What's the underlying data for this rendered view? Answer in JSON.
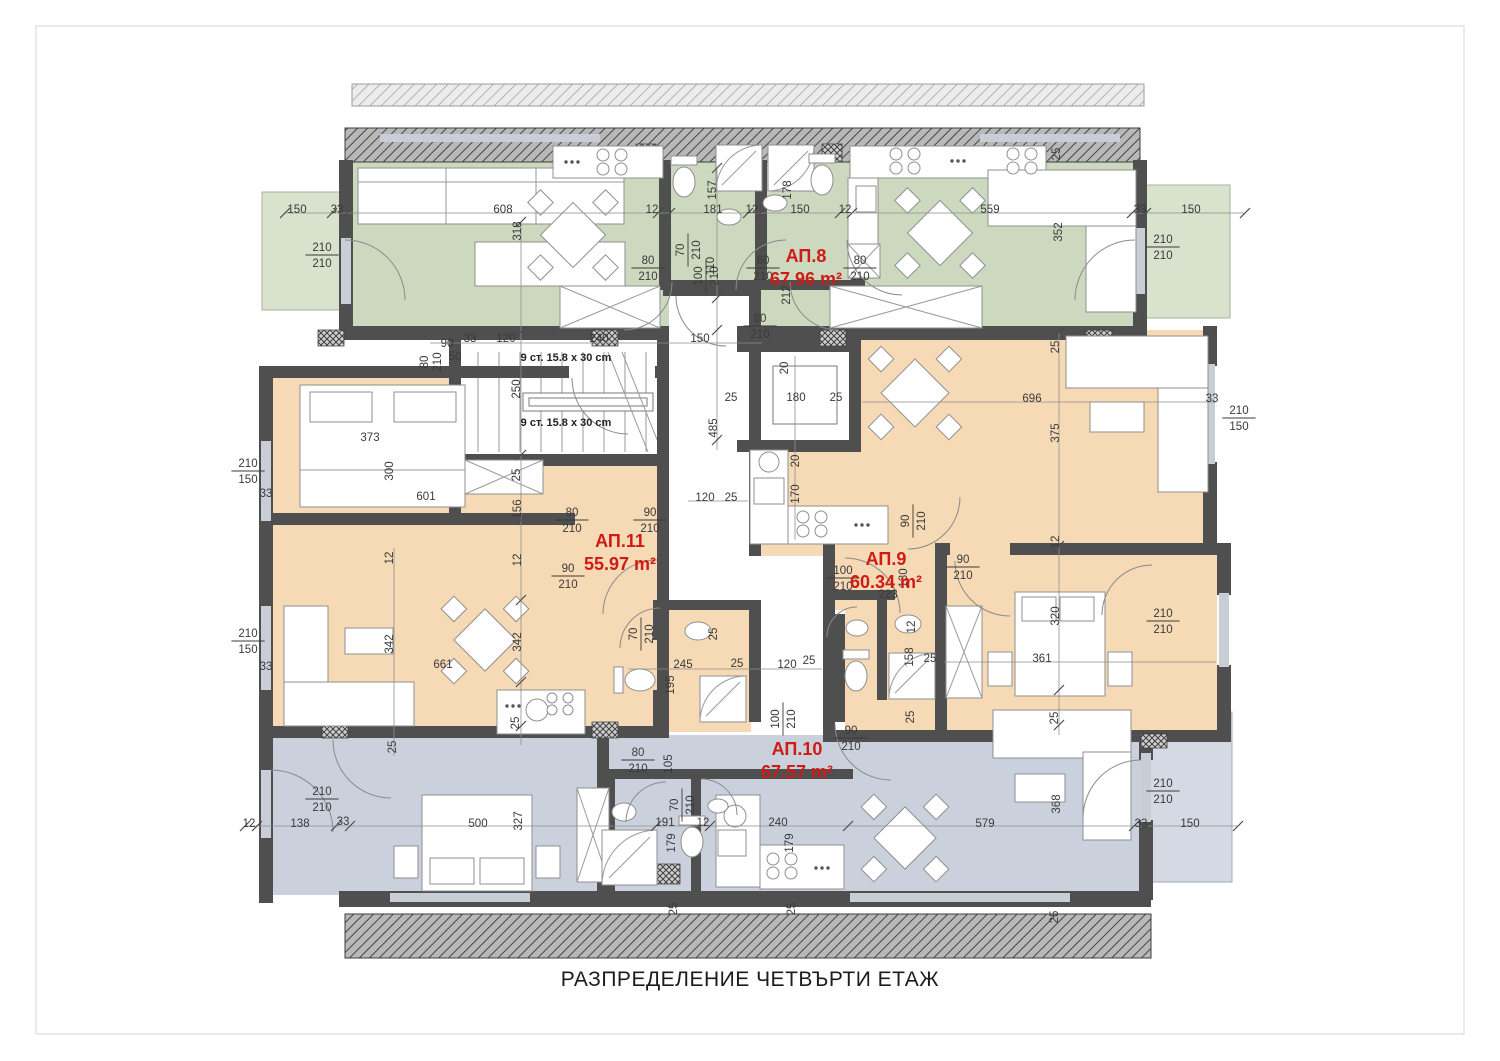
{
  "title": "РАЗПРЕДЕЛЕНИЕ ЧЕТВЪРТИ ЕТАЖ",
  "stair_note": "9 ст. 15.8 x 30 cm",
  "colors": {
    "green": "#ccd9bf",
    "green_terrace": "#d8e2cd",
    "orange": "#f6d9b5",
    "blue": "#cbd1dc",
    "blue_terrace": "#d4d9e3",
    "wall": "#4f4f4f",
    "label_red": "#cf1b15"
  },
  "apartments": [
    {
      "id": "АП.8",
      "area": "67.96 m²",
      "x": 806,
      "y": 262
    },
    {
      "id": "АП.11",
      "area": "55.97 m²",
      "x": 620,
      "y": 547
    },
    {
      "id": "АП.9",
      "area": "60.34 m²",
      "x": 886,
      "y": 565
    },
    {
      "id": "АП.10",
      "area": "67.57 m²",
      "x": 797,
      "y": 755
    }
  ],
  "notes": [
    {
      "t": "9 ст. 15.8 x 30 cm",
      "x": 566,
      "y": 361
    },
    {
      "t": "9 ст. 15.8 x 30 cm",
      "x": 566,
      "y": 426
    }
  ],
  "dims": [
    {
      "t": "150",
      "x": 297,
      "y": 209
    },
    {
      "t": "33",
      "x": 337,
      "y": 209
    },
    {
      "t": "608",
      "x": 503,
      "y": 209
    },
    {
      "t": "12",
      "x": 652,
      "y": 209
    },
    {
      "t": "181",
      "x": 713,
      "y": 209
    },
    {
      "t": "12",
      "x": 752,
      "y": 209
    },
    {
      "t": "150",
      "x": 800,
      "y": 209
    },
    {
      "t": "12",
      "x": 845,
      "y": 209
    },
    {
      "t": "559",
      "x": 990,
      "y": 209
    },
    {
      "t": "33",
      "x": 1140,
      "y": 209
    },
    {
      "t": "150",
      "x": 1191,
      "y": 209
    },
    {
      "t": "318",
      "x": 521,
      "y": 227,
      "r": 1
    },
    {
      "t": "157",
      "x": 716,
      "y": 186,
      "r": 1
    },
    {
      "t": "178",
      "x": 791,
      "y": 186,
      "r": 1
    },
    {
      "t": "352",
      "x": 1062,
      "y": 228,
      "r": 1
    },
    {
      "t": "25",
      "x": 1060,
      "y": 150,
      "r": 1
    },
    {
      "t": "90",
      "x": 447,
      "y": 343
    },
    {
      "t": "33",
      "x": 470,
      "y": 338
    },
    {
      "t": "120",
      "x": 506,
      "y": 338
    },
    {
      "t": "240",
      "x": 599,
      "y": 338
    },
    {
      "t": "150",
      "x": 700,
      "y": 338
    },
    {
      "t": "250",
      "x": 520,
      "y": 385,
      "r": 1
    },
    {
      "t": "80",
      "x": 428,
      "y": 358,
      "r": 1
    },
    {
      "t": "210",
      "x": 441,
      "y": 358,
      "r": 1
    },
    {
      "t": "50",
      "x": 455,
      "y": 356
    },
    {
      "t": "212",
      "x": 790,
      "y": 291,
      "r": 1
    },
    {
      "t": "110",
      "x": 714,
      "y": 262,
      "r": 1
    },
    {
      "t": "20",
      "x": 788,
      "y": 364,
      "r": 1
    },
    {
      "t": "25",
      "x": 731,
      "y": 397
    },
    {
      "t": "180",
      "x": 796,
      "y": 397
    },
    {
      "t": "25",
      "x": 836,
      "y": 397
    },
    {
      "t": "485",
      "x": 717,
      "y": 424,
      "r": 1
    },
    {
      "t": "20",
      "x": 799,
      "y": 457,
      "r": 1
    },
    {
      "t": "170",
      "x": 799,
      "y": 490,
      "r": 1
    },
    {
      "t": "120",
      "x": 705,
      "y": 497
    },
    {
      "t": "25",
      "x": 731,
      "y": 497
    },
    {
      "t": "373",
      "x": 370,
      "y": 437
    },
    {
      "t": "300",
      "x": 393,
      "y": 467,
      "r": 1
    },
    {
      "t": "601",
      "x": 426,
      "y": 496
    },
    {
      "t": "156",
      "x": 521,
      "y": 505,
      "r": 1
    },
    {
      "t": "25",
      "x": 520,
      "y": 471,
      "r": 1
    },
    {
      "t": "33",
      "x": 266,
      "y": 493
    },
    {
      "t": "33",
      "x": 266,
      "y": 666
    },
    {
      "t": "12",
      "x": 393,
      "y": 554,
      "r": 1
    },
    {
      "t": "12",
      "x": 521,
      "y": 556,
      "r": 1
    },
    {
      "t": "342",
      "x": 393,
      "y": 640,
      "r": 1
    },
    {
      "t": "342",
      "x": 521,
      "y": 638,
      "r": 1
    },
    {
      "t": "661",
      "x": 443,
      "y": 664
    },
    {
      "t": "25",
      "x": 396,
      "y": 743,
      "r": 1
    },
    {
      "t": "25",
      "x": 519,
      "y": 719,
      "r": 1
    },
    {
      "t": "245",
      "x": 683,
      "y": 664
    },
    {
      "t": "25",
      "x": 737,
      "y": 663
    },
    {
      "t": "195",
      "x": 674,
      "y": 681,
      "r": 1
    },
    {
      "t": "25",
      "x": 717,
      "y": 630,
      "r": 1
    },
    {
      "t": "120",
      "x": 787,
      "y": 664
    },
    {
      "t": "25",
      "x": 809,
      "y": 660
    },
    {
      "t": "696",
      "x": 1032,
      "y": 398
    },
    {
      "t": "375",
      "x": 1059,
      "y": 429,
      "r": 1
    },
    {
      "t": "25",
      "x": 1059,
      "y": 343,
      "r": 1
    },
    {
      "t": "33",
      "x": 1212,
      "y": 398
    },
    {
      "t": "12",
      "x": 1059,
      "y": 538,
      "r": 1
    },
    {
      "t": "223",
      "x": 888,
      "y": 594
    },
    {
      "t": "130",
      "x": 907,
      "y": 574,
      "r": 1
    },
    {
      "t": "12",
      "x": 915,
      "y": 623,
      "r": 1
    },
    {
      "t": "158",
      "x": 913,
      "y": 653,
      "r": 1
    },
    {
      "t": "25",
      "x": 930,
      "y": 658
    },
    {
      "t": "320",
      "x": 1059,
      "y": 612,
      "r": 1
    },
    {
      "t": "361",
      "x": 1042,
      "y": 658
    },
    {
      "t": "25",
      "x": 1058,
      "y": 714,
      "r": 1
    },
    {
      "t": "25",
      "x": 914,
      "y": 713,
      "r": 1
    },
    {
      "t": "12",
      "x": 249,
      "y": 823
    },
    {
      "t": "138",
      "x": 300,
      "y": 823
    },
    {
      "t": "33",
      "x": 343,
      "y": 821
    },
    {
      "t": "500",
      "x": 478,
      "y": 823
    },
    {
      "t": "327",
      "x": 522,
      "y": 817,
      "r": 1
    },
    {
      "t": "105",
      "x": 672,
      "y": 760,
      "r": 1
    },
    {
      "t": "191",
      "x": 665,
      "y": 822
    },
    {
      "t": "12",
      "x": 703,
      "y": 822
    },
    {
      "t": "240",
      "x": 778,
      "y": 822
    },
    {
      "t": "179",
      "x": 675,
      "y": 839,
      "r": 1
    },
    {
      "t": "179",
      "x": 793,
      "y": 839,
      "r": 1
    },
    {
      "t": "25",
      "x": 677,
      "y": 905,
      "r": 1
    },
    {
      "t": "25",
      "x": 795,
      "y": 905,
      "r": 1
    },
    {
      "t": "579",
      "x": 985,
      "y": 823
    },
    {
      "t": "368",
      "x": 1060,
      "y": 800,
      "r": 1
    },
    {
      "t": "33",
      "x": 1141,
      "y": 823
    },
    {
      "t": "150",
      "x": 1190,
      "y": 823
    },
    {
      "t": "25",
      "x": 1058,
      "y": 913,
      "r": 1
    }
  ],
  "fracs": [
    {
      "a": "70",
      "b": "210",
      "x": 687,
      "y": 250,
      "r": 1
    },
    {
      "a": "80",
      "b": "210",
      "x": 648,
      "y": 267
    },
    {
      "a": "80",
      "b": "210",
      "x": 763,
      "y": 267
    },
    {
      "a": "80",
      "b": "210",
      "x": 860,
      "y": 267
    },
    {
      "a": "100",
      "b": "210",
      "x": 705,
      "y": 276,
      "r": 1
    },
    {
      "a": "80",
      "b": "210",
      "x": 760,
      "y": 325
    },
    {
      "a": "210",
      "b": "210",
      "x": 322,
      "y": 254
    },
    {
      "a": "210",
      "b": "210",
      "x": 1163,
      "y": 246
    },
    {
      "a": "210",
      "b": "150",
      "x": 248,
      "y": 470
    },
    {
      "a": "210",
      "b": "150",
      "x": 248,
      "y": 640
    },
    {
      "a": "210",
      "b": "210",
      "x": 322,
      "y": 798
    },
    {
      "a": "80",
      "b": "210",
      "x": 572,
      "y": 519
    },
    {
      "a": "90",
      "b": "210",
      "x": 650,
      "y": 519
    },
    {
      "a": "90",
      "b": "210",
      "x": 568,
      "y": 575
    },
    {
      "a": "210",
      "b": "150",
      "x": 1239,
      "y": 417
    },
    {
      "a": "90",
      "b": "210",
      "x": 912,
      "y": 521,
      "r": 1
    },
    {
      "a": "100",
      "b": "210",
      "x": 843,
      "y": 577
    },
    {
      "a": "90",
      "b": "210",
      "x": 963,
      "y": 566
    },
    {
      "a": "210",
      "b": "210",
      "x": 1163,
      "y": 620
    },
    {
      "a": "70",
      "b": "210",
      "x": 640,
      "y": 634,
      "r": 1
    },
    {
      "a": "100",
      "b": "210",
      "x": 782,
      "y": 719,
      "r": 1
    },
    {
      "a": "90",
      "b": "210",
      "x": 851,
      "y": 737
    },
    {
      "a": "80",
      "b": "210",
      "x": 638,
      "y": 759
    },
    {
      "a": "70",
      "b": "210",
      "x": 681,
      "y": 805,
      "r": 1
    },
    {
      "a": "210",
      "b": "210",
      "x": 1163,
      "y": 790
    }
  ]
}
